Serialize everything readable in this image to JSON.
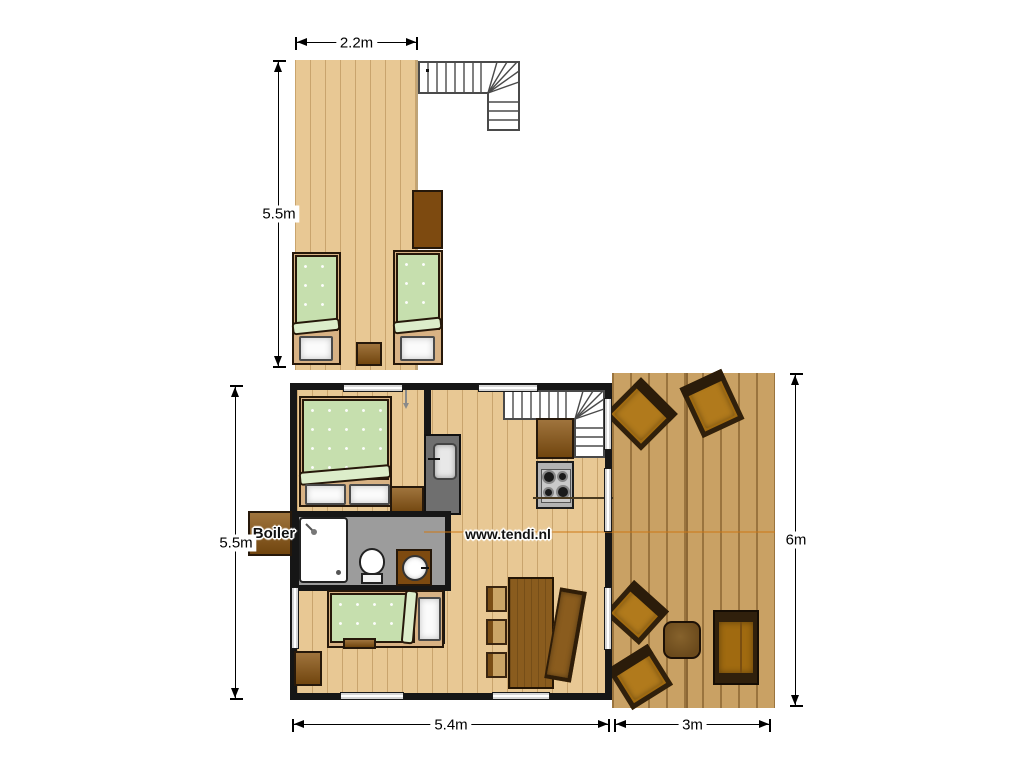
{
  "watermark": "www.tendi.nl",
  "labels": {
    "boiler": "Boiler"
  },
  "dimensions": {
    "upper_floor_width": "2.2m",
    "upper_floor_length": "5.5m",
    "ground_floor_length": "5.5m",
    "ground_floor_width": "5.4m",
    "deck_width": "3m",
    "deck_length": "6m"
  },
  "colors": {
    "interior_floor": "#e8c894",
    "deck_floor": "#c9a164",
    "wall": "#161616",
    "bedding_green": "#c6dfae",
    "furniture_brown": "#8a5512",
    "bathroom_floor": "#9c9c9c"
  },
  "inventory": {
    "upper_floor": [
      "staircase",
      "wardrobe",
      "single-bed",
      "single-bed",
      "side-table"
    ],
    "ground_floor": [
      "double-bed",
      "cabinet",
      "sink-unit",
      "kitchen-cabinet",
      "gas-stove",
      "staircase",
      "shower",
      "toilet",
      "washbasin",
      "boiler",
      "single-bed",
      "bench",
      "corner-cabinet",
      "dining-table",
      "chair",
      "chair",
      "chair",
      "bench-seat"
    ],
    "deck": [
      "armchair",
      "armchair",
      "armchair",
      "armchair",
      "coffee-table",
      "sofa"
    ]
  }
}
